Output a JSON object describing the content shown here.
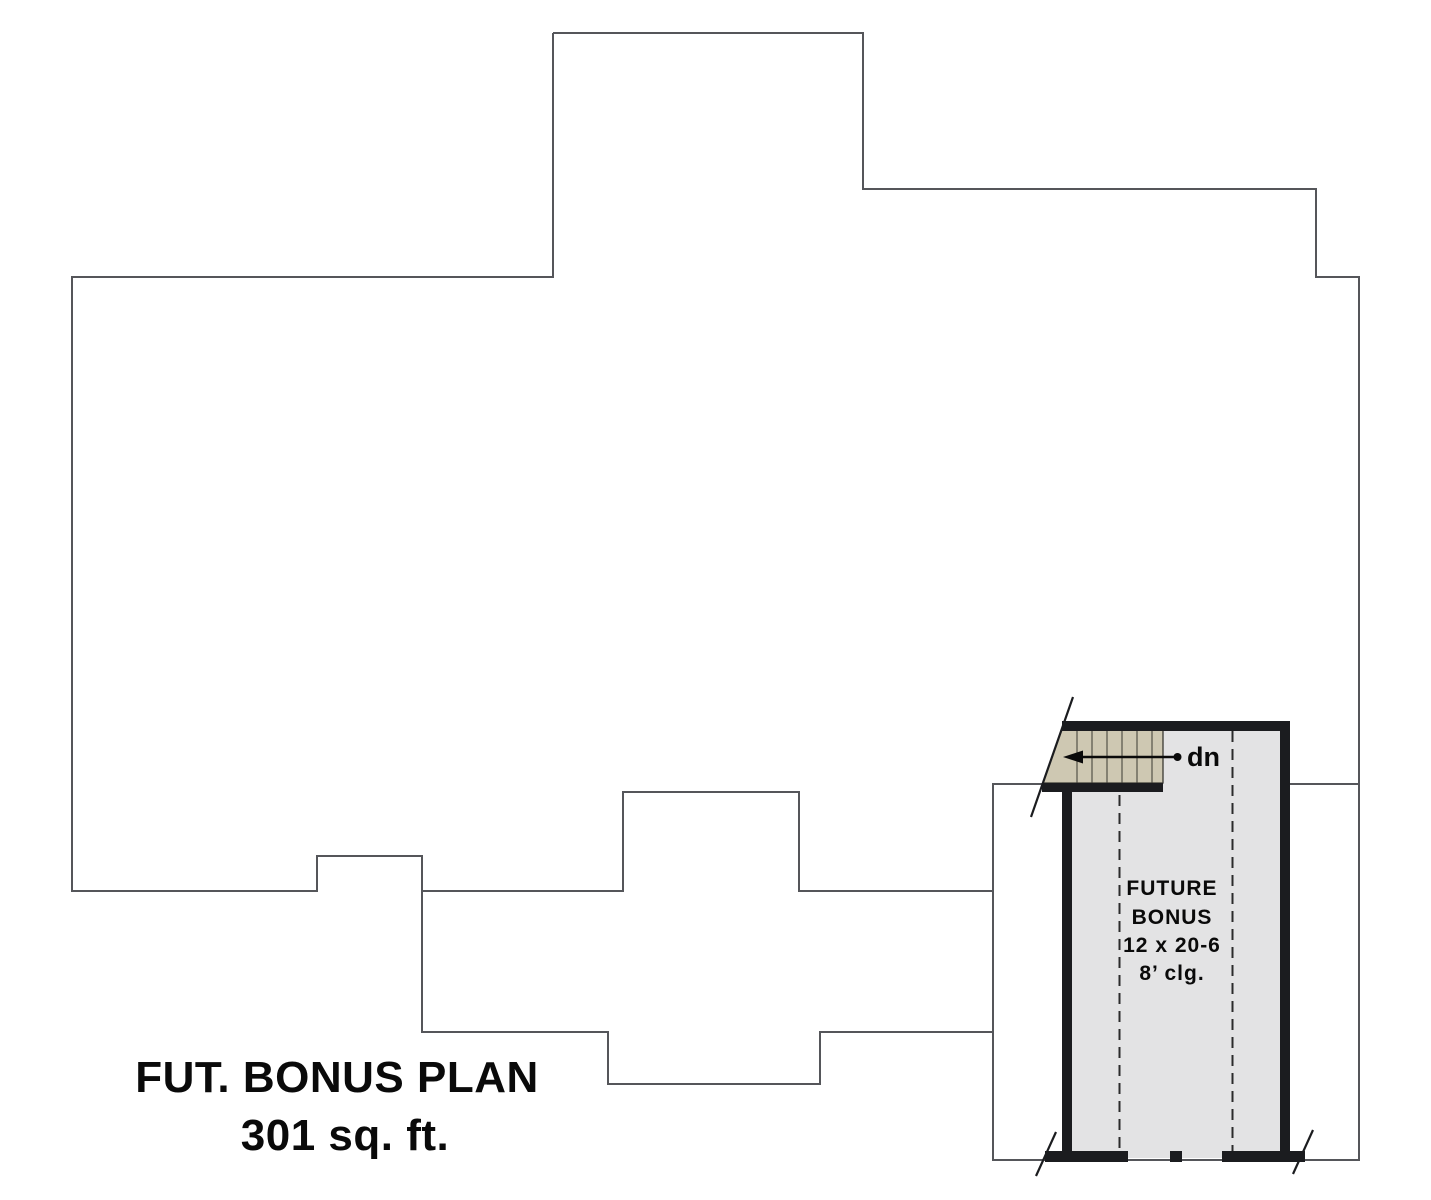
{
  "plan": {
    "title_line1": "FUT. BONUS PLAN",
    "title_line2": "301 sq. ft.",
    "room": {
      "name_line1": "FUTURE",
      "name_line2": "BONUS",
      "dimensions": "12 x 20-6",
      "ceiling": "8’ clg."
    },
    "stair": {
      "direction_label": "dn"
    }
  },
  "colors": {
    "background": "#ffffff",
    "outline": "#55565a",
    "wall": "#1b1c1f",
    "room_fill": "#e3e3e4",
    "stair_fill": "#cec8b2",
    "dash": "#2b2b2b",
    "text": "#0a0a0a"
  }
}
